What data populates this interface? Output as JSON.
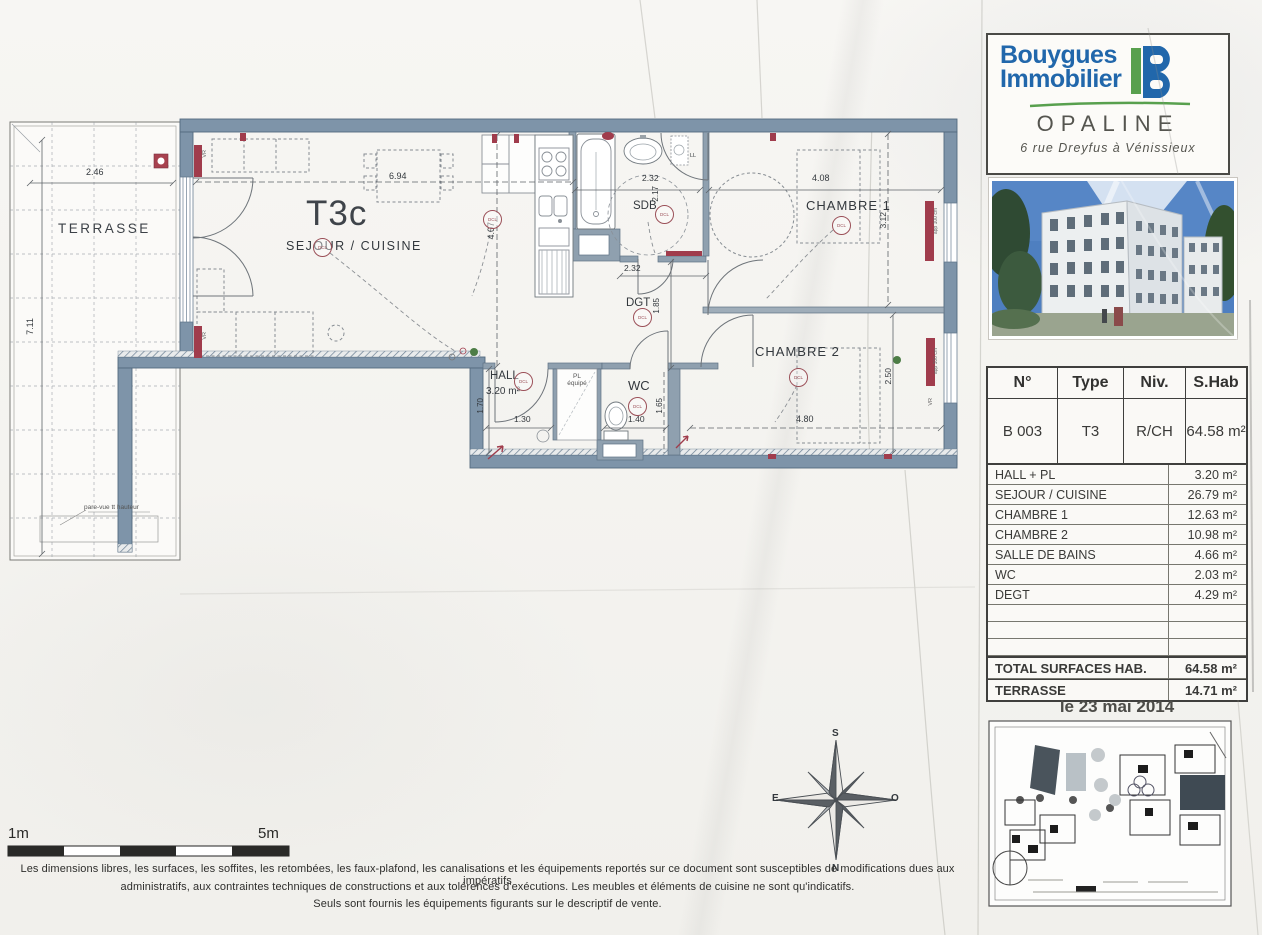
{
  "plan": {
    "unit": "T3c",
    "rooms": {
      "terrasse": "TERRASSE",
      "sejour": "SEJOUR / CUISINE",
      "sdb": "SDB",
      "dgt": "DGT",
      "chambre1": "CHAMBRE 1",
      "chambre2": "CHAMBRE 2",
      "hall": "HALL",
      "hall_area": "3.20 m²",
      "wc": "WC",
      "pl_line1": "PL",
      "pl_line2": "équipé"
    },
    "dims": {
      "terrasse_w": "2.46",
      "terrasse_h": "7.11",
      "sejour_w": "6.94",
      "sejour_h": "4.07",
      "sdb_w": "2.32",
      "sdb_h": "2.17",
      "sdb_w2": "2.32",
      "dgt_h": "1.85",
      "ch1_w": "4.08",
      "ch1_h": "3.12",
      "ch2_w": "4.80",
      "ch2_h": "2.50",
      "hall_w": "1.30",
      "hall_h": "1.70",
      "wc_w": "1.40",
      "wc_h": "1.65"
    },
    "annotations": {
      "dcl": "DCL",
      "ll": "LL",
      "vr": "VR",
      "app100": "app 100 cm",
      "pare_vue": "pare-vue tt hauteur"
    },
    "compass": {
      "n": "N",
      "s": "S",
      "e": "E",
      "o": "O"
    },
    "scale": {
      "left": "1m",
      "right": "5m"
    }
  },
  "sidebar": {
    "brand": {
      "name_line1": "Bouygues",
      "name_line2": "Immobilier",
      "logo_letter": "B",
      "program": "OPALINE",
      "address": "6 rue Dreyfus à Vénissieux"
    },
    "summary": {
      "headers": [
        "N°",
        "Type",
        "Niv.",
        "S.Hab"
      ],
      "values": [
        "B 003",
        "T3",
        "R/CH",
        "64.58 m²"
      ]
    },
    "areas": [
      {
        "label": "HALL + PL",
        "value": "3.20 m²"
      },
      {
        "label": "SEJOUR / CUISINE",
        "value": "26.79 m²"
      },
      {
        "label": "CHAMBRE 1",
        "value": "12.63 m²"
      },
      {
        "label": "CHAMBRE 2",
        "value": "10.98 m²"
      },
      {
        "label": "SALLE DE BAINS",
        "value": "4.66 m²"
      },
      {
        "label": "WC",
        "value": "2.03 m²"
      },
      {
        "label": "DEGT",
        "value": "4.29 m²"
      }
    ],
    "totals": [
      {
        "label": "TOTAL SURFACES HAB.",
        "value": "64.58 m²"
      },
      {
        "label": "TERRASSE",
        "value": "14.71 m²"
      }
    ],
    "date": "le 23 mai 2014"
  },
  "footer": {
    "line1": "Les dimensions libres, les surfaces, les soffites, les retombées, les faux-plafond, les canalisations et les équipements reportés sur ce document sont susceptibles de modifications  dues aux impératifs",
    "line2": "administratifs, aux contraintes techniques de constructions et aux tolérences d'exécutions. Les meubles et éléments de cuisine ne sont qu'indicatifs.",
    "line3": "Seuls sont fournis les équipements figurants sur le descriptif de vente."
  }
}
